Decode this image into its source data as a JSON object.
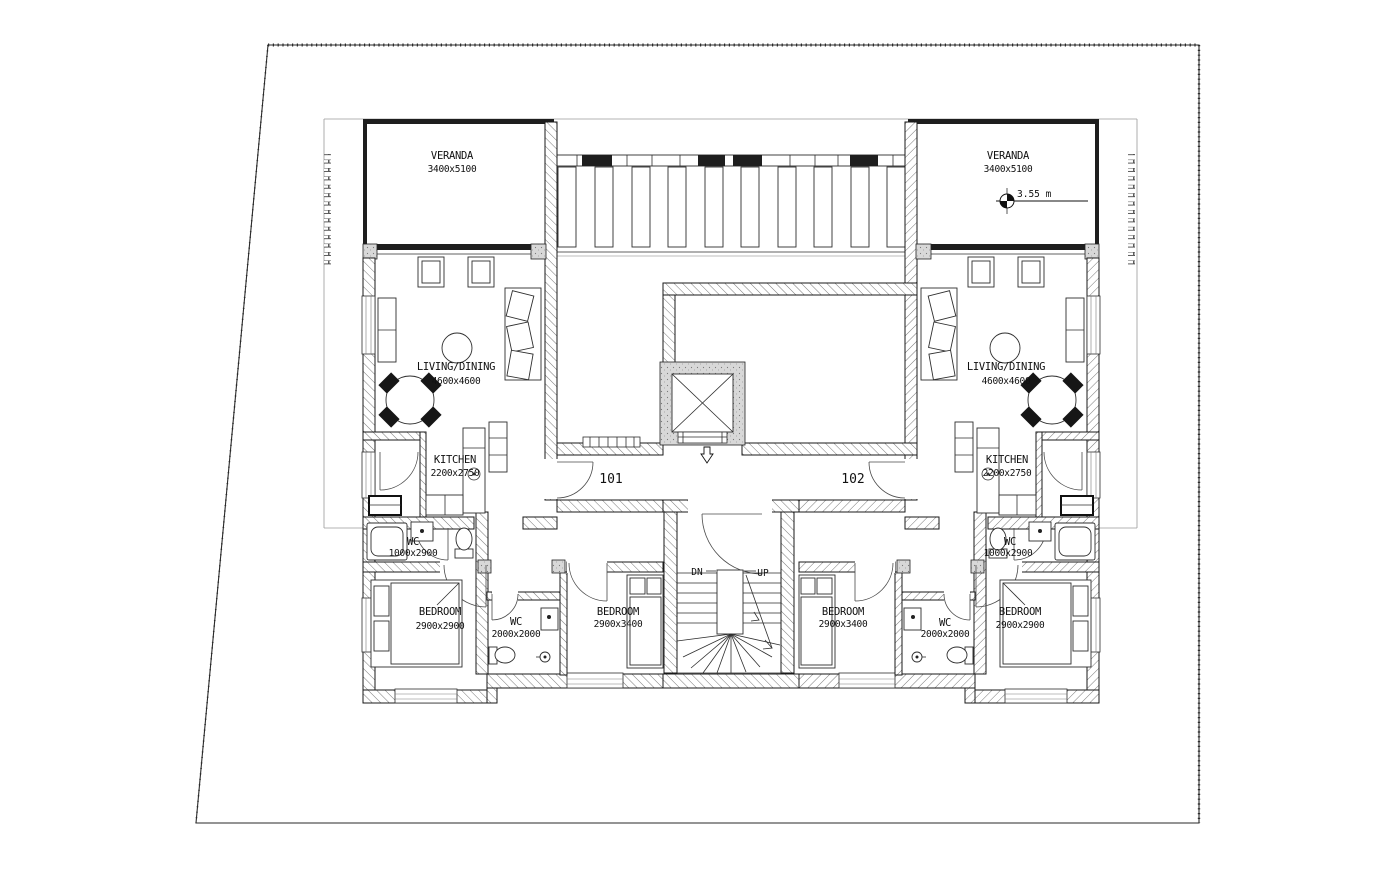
{
  "drawing": {
    "type": "residential floor plan",
    "level_marker": "3.55 m",
    "corridor": {
      "unit_left_number": "101",
      "unit_right_number": "102"
    },
    "stairs": {
      "down": "DN",
      "up": "UP"
    },
    "rooms": {
      "left": {
        "veranda": {
          "name": "VERANDA",
          "dims": "3400x5100"
        },
        "living": {
          "name": "LIVING/DINING",
          "dims": "4600x4600"
        },
        "kitchen": {
          "name": "KITCHEN",
          "dims": "2200x2750"
        },
        "wc": {
          "name": "WC",
          "dims": "1000x2900"
        },
        "bedroom_outer": {
          "name": "BEDROOM",
          "dims": "2900x2900"
        },
        "wc_inner": {
          "name": "WC",
          "dims": "2000x2000"
        },
        "bedroom_inner": {
          "name": "BEDROOM",
          "dims": "2900x3400"
        }
      },
      "right": {
        "veranda": {
          "name": "VERANDA",
          "dims": "3400x5100"
        },
        "living": {
          "name": "LIVING/DINING",
          "dims": "4600x4600"
        },
        "kitchen": {
          "name": "KITCHEN",
          "dims": "2200x2750"
        },
        "wc": {
          "name": "WC",
          "dims": "1000x2900"
        },
        "bedroom_outer": {
          "name": "BEDROOM",
          "dims": "2900x2900"
        },
        "wc_inner": {
          "name": "WC",
          "dims": "2000x2000"
        },
        "bedroom_inner": {
          "name": "BEDROOM",
          "dims": "2900x3400"
        }
      }
    },
    "colors": {
      "background": "#ffffff",
      "line": "#1a1a1a",
      "wall_dark": "#1e1e1e",
      "concrete": "#d8d8d8",
      "hatch": "#555555"
    }
  }
}
